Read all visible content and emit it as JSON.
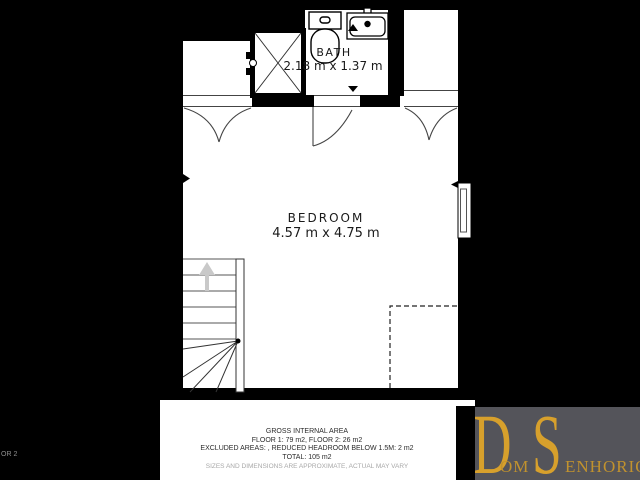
{
  "plan": {
    "bath": {
      "name": "BATH",
      "dimensions": "2.18 m x 1.37 m"
    },
    "bedroom": {
      "name": "BEDROOM",
      "dimensions": "4.57 m x 4.75 m"
    }
  },
  "footer": {
    "lines": [
      "GROSS INTERNAL AREA",
      "FLOOR 1: 79 m2, FLOOR 2: 26 m2",
      "EXCLUDED AREAS: , REDUCED HEADROOM BELOW 1.5M: 2 m2",
      "TOTAL: 105 m2"
    ],
    "disclaimer": "SIZES AND DIMENSIONS ARE APPROXIMATE, ACTUAL MAY VARY"
  },
  "logo": {
    "big1": "D",
    "small1": "OM",
    "big2": "S",
    "small2": "ENHORIO"
  },
  "edge_label": "OR 2",
  "colors": {
    "gold": "#D7A02C",
    "gold_small": "#C1922E",
    "logo_bg": "#54545A",
    "wall": "#000000",
    "floor": "#FFFFFF"
  }
}
